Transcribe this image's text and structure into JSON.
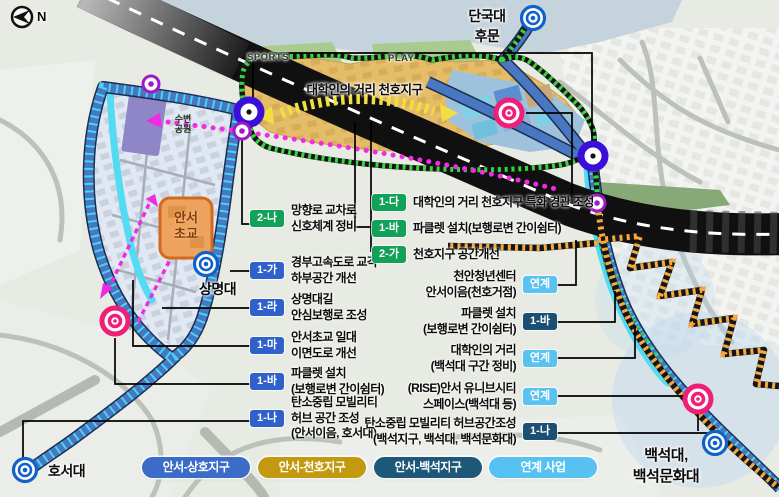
{
  "compass": {
    "n": "N"
  },
  "map": {
    "street_title": "대학인의 거리 천호지구",
    "sports": "SPORTS",
    "play": "PLAY",
    "park_line1": "수변",
    "park_line2": "공원",
    "school_line1": "안서",
    "school_line2": "초교"
  },
  "universities": {
    "dankook_line1": "단국대",
    "dankook_line2": "후문",
    "sangmyung": "상명대",
    "hoseo": "호서대",
    "baekseok_line1": "백석대,",
    "baekseok_line2": "백석문화대"
  },
  "callouts": {
    "left": [
      {
        "code": "2-나",
        "lines": [
          "망향로 교차로",
          "신호체계 정비"
        ]
      },
      {
        "code": "1-가",
        "lines": [
          "경부고속도로 교각",
          "하부공간 개선"
        ]
      },
      {
        "code": "1-라",
        "lines": [
          "상명대길",
          "안심보행로 조성"
        ]
      },
      {
        "code": "1-마",
        "lines": [
          "안서초교 일대",
          "이면도로 개선"
        ]
      },
      {
        "code": "1-바",
        "lines": [
          "파클렛 설치",
          "(보행로변 간이쉼터)"
        ]
      },
      {
        "code": "1-나",
        "lines": [
          "탄소중립 모빌리티",
          "허브 공간 조성",
          "(안서이음, 호서대)"
        ]
      }
    ],
    "center": [
      {
        "code": "1-다",
        "lines": [
          "대학인의 거리 천호지구 특화 경관 조성"
        ]
      },
      {
        "code": "1-바",
        "lines": [
          "파클렛 설치(보행로변 간이쉼터)"
        ]
      },
      {
        "code": "2-가",
        "lines": [
          "천호지구 공간개선"
        ]
      }
    ],
    "right": [
      {
        "code": "연계",
        "lines": [
          "천안청년센터",
          "안서이음(천호거점)"
        ]
      },
      {
        "code": "1-바",
        "lines": [
          "파클렛 설치",
          "(보행로변 간이쉼터)"
        ]
      },
      {
        "code": "연계",
        "lines": [
          "대학인의 거리",
          "(백석대 구간 정비)"
        ]
      },
      {
        "code": "연계",
        "lines": [
          "(RISE)안서 유니브시티",
          "스페이스(백석대 등)"
        ]
      },
      {
        "code": "1-나",
        "lines": [
          "탄소중립 모빌리티 허브공간조성",
          "(백석지구, 백석대, 백석문화대)"
        ]
      }
    ]
  },
  "legend": {
    "items": [
      {
        "label": "안서-상호지구",
        "color": "#3A6CC8"
      },
      {
        "label": "안서-천호지구",
        "color": "#C3990F"
      },
      {
        "label": "안서-백석지구",
        "color": "#1D5878"
      },
      {
        "label": "연계 사업",
        "color": "#57C2F2"
      }
    ]
  },
  "colors": {
    "badge_green": "#12A158",
    "badge_blue": "#3061CB",
    "badge_navy": "#1B4F73",
    "badge_link": "#58C3F0",
    "road_band": "#4A77C2",
    "stream": "#52DBF2",
    "district_tan": "#E5BD68",
    "path_orange": "#F7A93C",
    "path_green": "#38D43C",
    "accent_magenta": "#F02BE2",
    "target_pink": "#EF1F78",
    "target_blue": "#0F62C8",
    "signal_indigo": "#3A10D8"
  }
}
